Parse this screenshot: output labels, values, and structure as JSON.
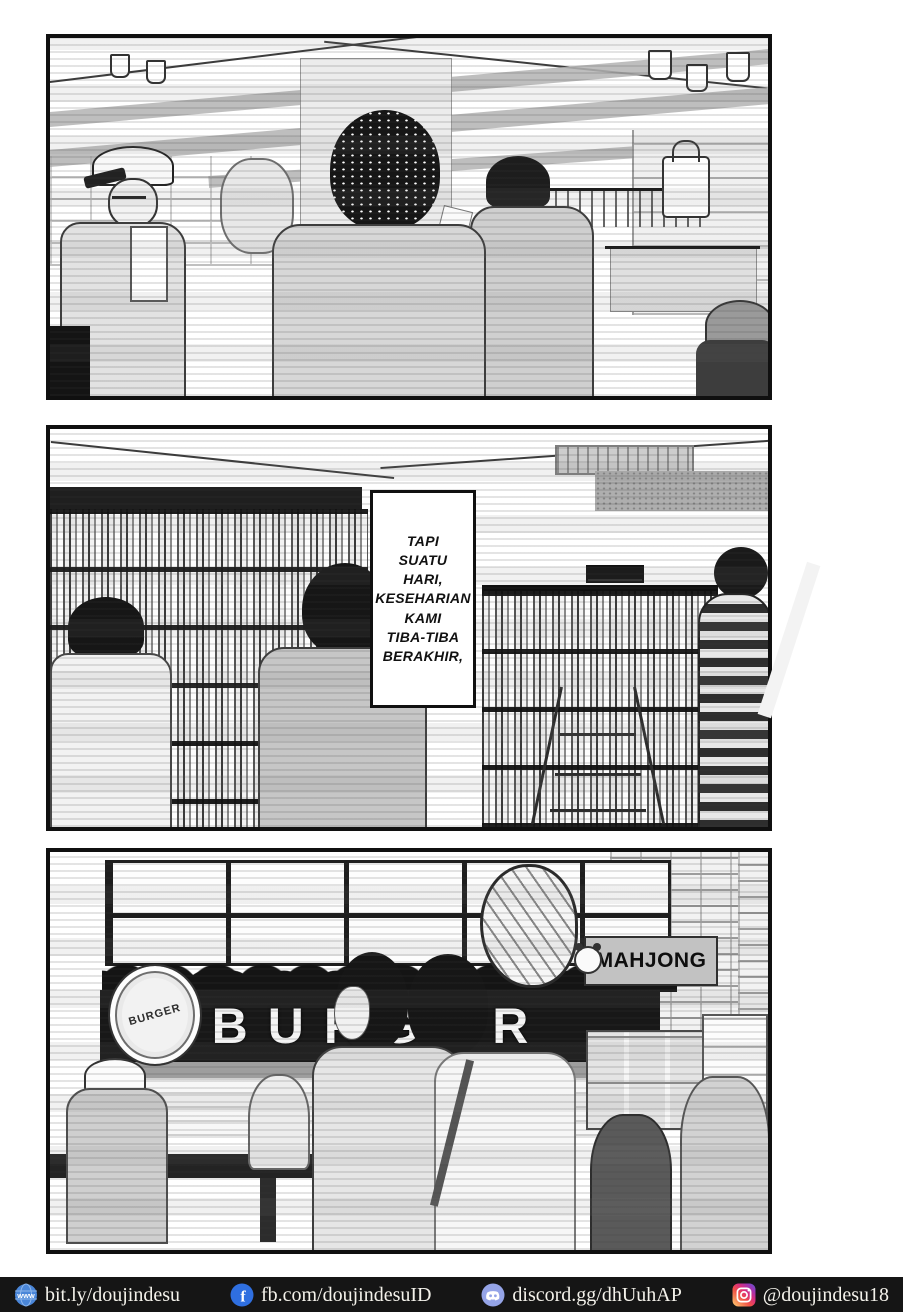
{
  "page": {
    "background": "#ffffff",
    "ink_color": "#101010"
  },
  "panel2": {
    "bubble": {
      "lines": [
        "TAPI",
        "SUATU",
        "HARI,",
        "KESEHARIAN",
        "KAMI",
        "TIBA-TIBA",
        "BERAKHIR,"
      ]
    }
  },
  "panel3": {
    "burger_sign": "BURGER",
    "badge_text": "BURGER",
    "mahjong_sign": "MAHJONG"
  },
  "footer": {
    "background": "#151515",
    "text_color": "#f3f1ea",
    "links": [
      {
        "icon": "www-globe-icon",
        "icon_text": "www",
        "icon_color": "#4a86d8",
        "label": "bit.ly/doujindesu"
      },
      {
        "icon": "facebook-icon",
        "icon_text": "f",
        "icon_color": "#2f6fe0",
        "label": "fb.com/doujindesuID"
      },
      {
        "icon": "discord-icon",
        "icon_color": "#95a4e7",
        "label": "discord.gg/dhUuhAP"
      },
      {
        "icon": "instagram-icon",
        "icon_gradient": [
          "#fed373",
          "#f15245",
          "#d92e7f",
          "#9b36b7",
          "#515ecf"
        ],
        "label": "@doujindesu18"
      }
    ]
  }
}
